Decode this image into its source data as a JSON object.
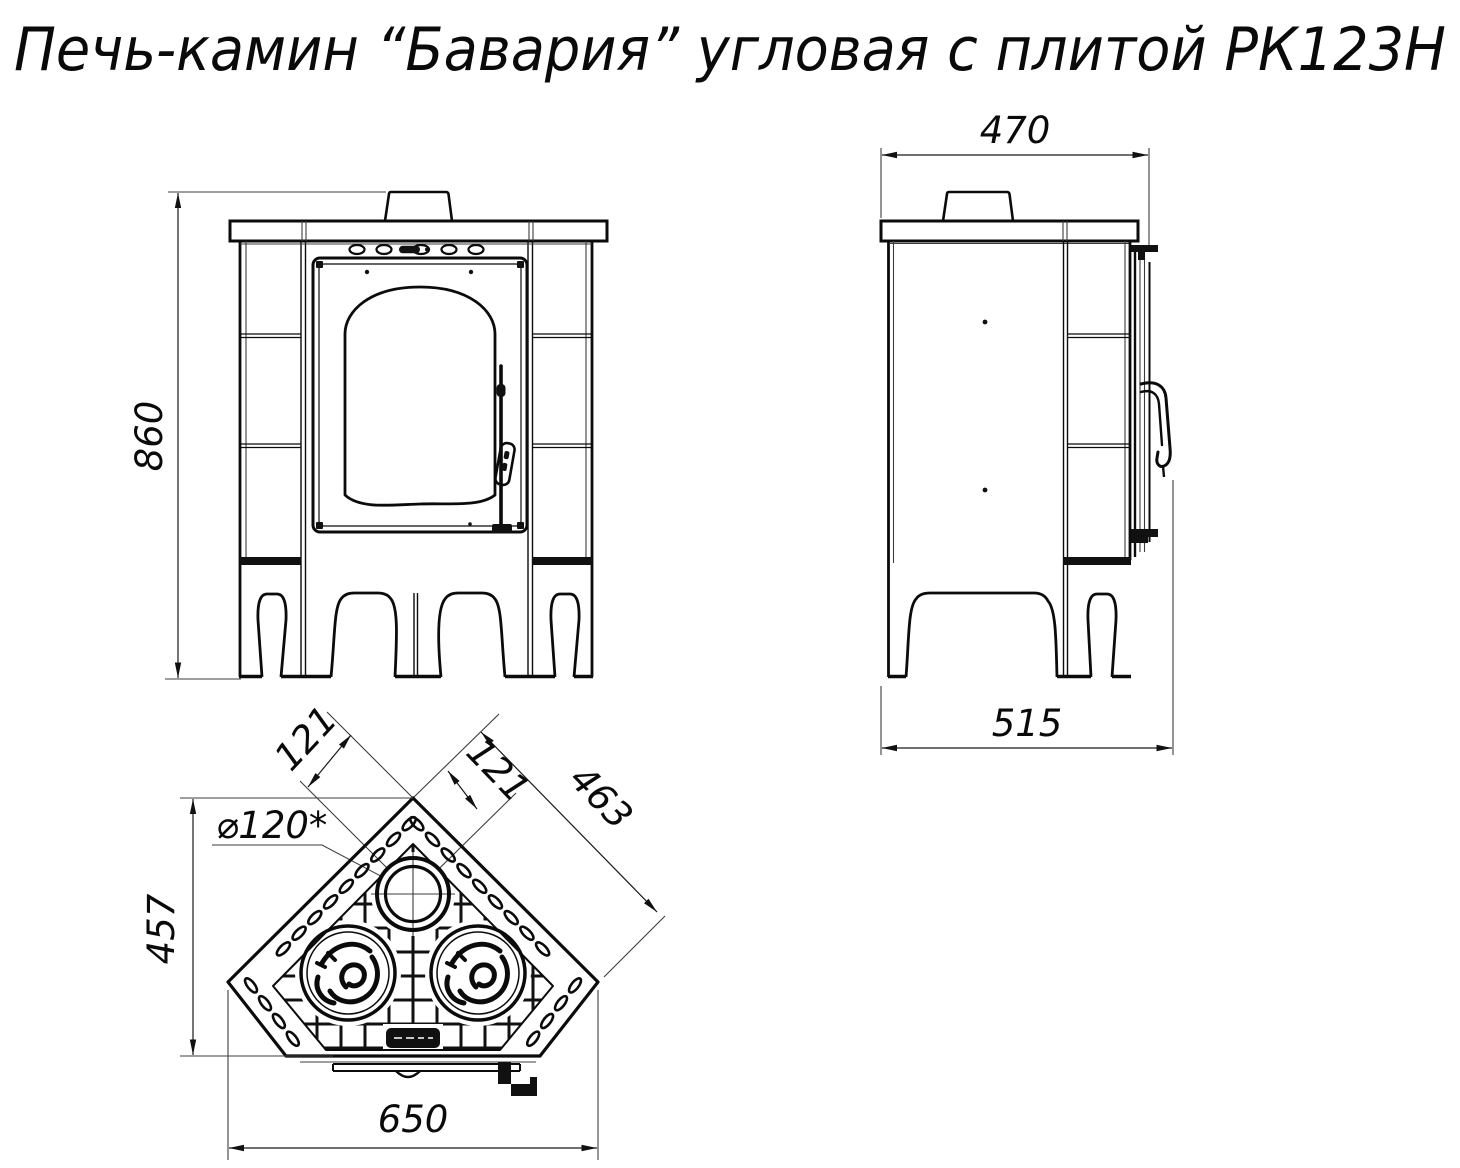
{
  "title": "Печь-камин “Бавария” угловая с плитой РК123Н",
  "drawing": {
    "front": {
      "height": "860"
    },
    "side": {
      "width": "470",
      "depth": "515"
    },
    "top": {
      "width": "650",
      "depth": "457",
      "front_edge": "463",
      "flue_offset_a": "121",
      "flue_offset_b": "121",
      "flue_diameter": "⌀120*"
    }
  }
}
